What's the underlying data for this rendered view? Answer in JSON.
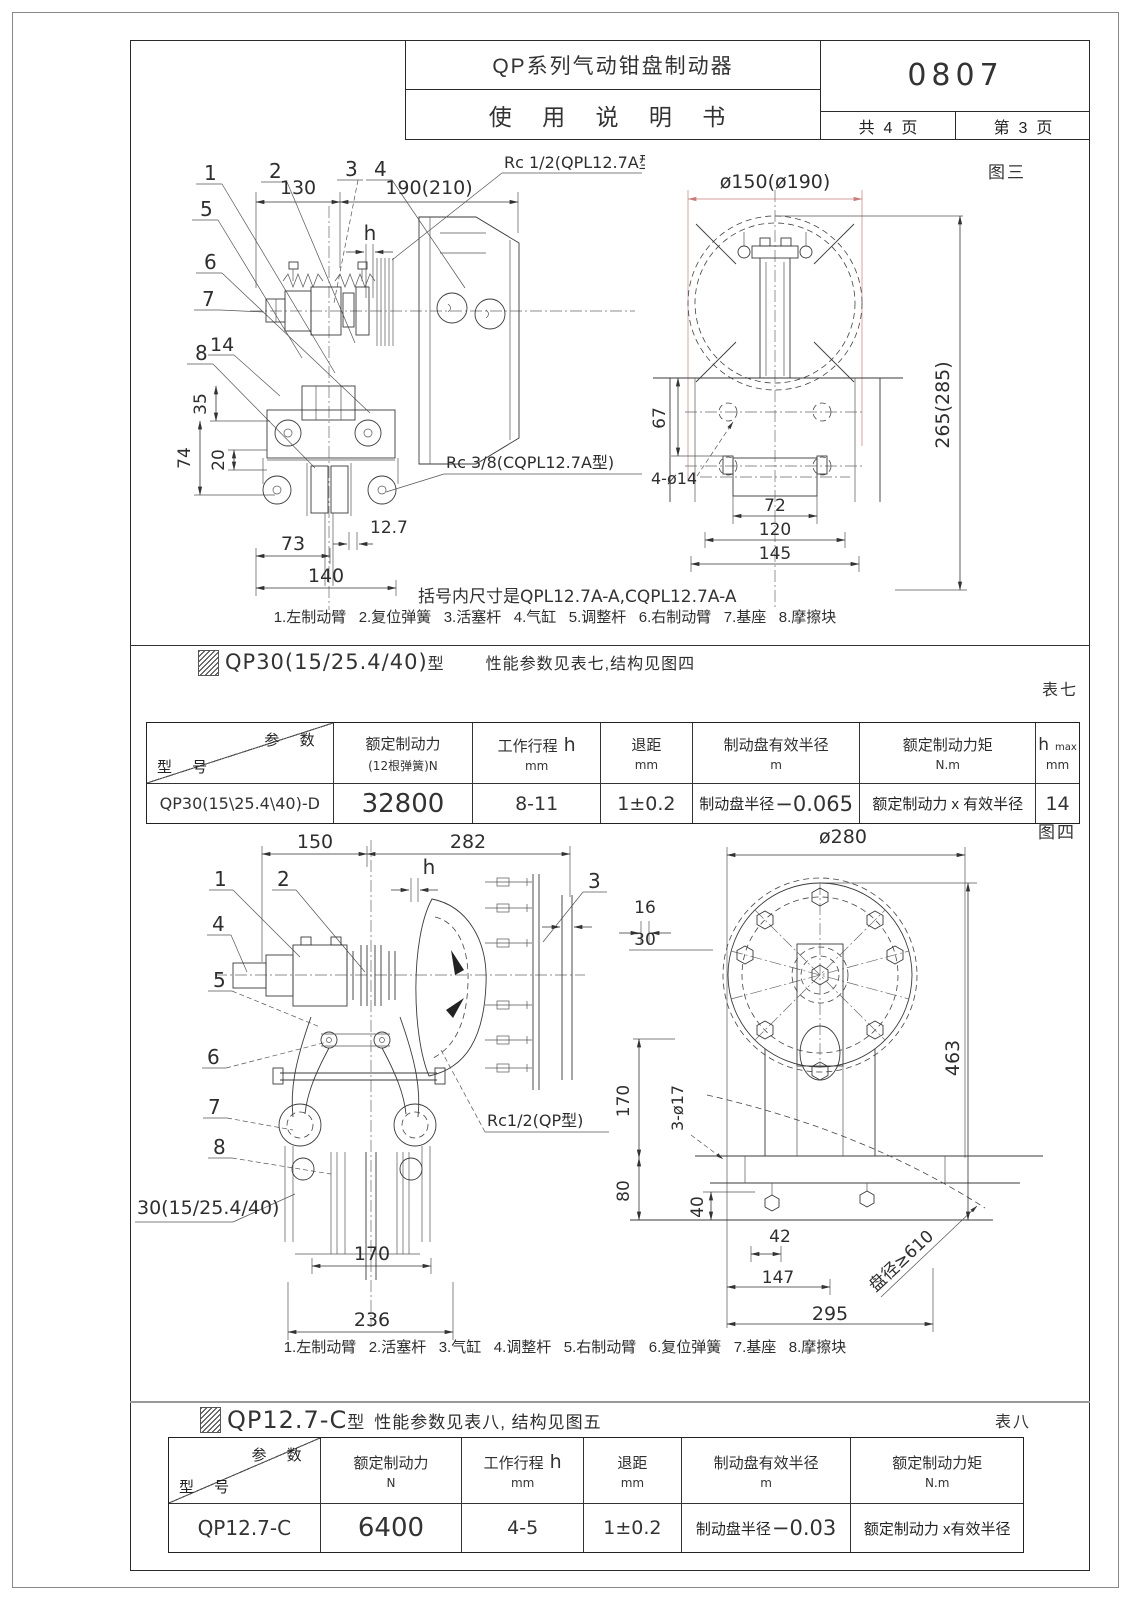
{
  "colors": {
    "dim_red": "#c87c7c",
    "line": "#333333"
  },
  "title_block": {
    "product": "QP系列气动钳盘制动器",
    "doc_type": "使 用 说 明 书",
    "doc_no": "0807",
    "pages_total": "共  4  页",
    "page_no": "第  3  页"
  },
  "fig3": {
    "caption": "图三",
    "note": "括号内尺寸是QPL12.7A-A,CQPL12.7A-A",
    "legend": "1.左制动臂   2.复位弹簧   3.活塞杆   4.气缸   5.调整杆   6.右制动臂   7.基座   8.摩擦块",
    "labels": {
      "n1": "1",
      "n2": "2",
      "n3": "3",
      "n4": "4",
      "n5": "5",
      "n6": "6",
      "n7": "7",
      "n8": "8",
      "n14": "14"
    },
    "dims": {
      "w130": "130",
      "w190": "190(210)",
      "h": "h",
      "rc12": "Rc 1/2(QPL12.7A型)",
      "rc38": "Rc 3/8(CQPL12.7A型)",
      "v35": "35",
      "v74": "74",
      "v20": "20",
      "t127": "12.7",
      "w73": "73",
      "w140": "140",
      "dia150": "ø150(ø190)",
      "v265": "265(285)",
      "v67": "67",
      "holes": "4-ø14",
      "w72": "72",
      "w120": "120",
      "w145": "145"
    }
  },
  "sec7": {
    "model": "QP30(15/25.4/40)",
    "suffix": "型",
    "desc": "性能参数见表七,结构见图四",
    "tag": "表七"
  },
  "table7": {
    "corner_top": "参 数",
    "corner_bottom": "型 号",
    "c1": {
      "t": "额定制动力",
      "s": "(12根弹簧)N"
    },
    "c2": {
      "t": "工作行程",
      "t2": "h",
      "s": "mm"
    },
    "c3": {
      "t": "退距",
      "s": "mm"
    },
    "c4": {
      "t": "制动盘有效半径",
      "s": "m"
    },
    "c5": {
      "t": "额定制动力矩",
      "s": "N.m"
    },
    "c6": {
      "t": "h",
      "tsub": "max",
      "s": "mm"
    },
    "row": {
      "model": "QP30(15\\25.4\\40)-D",
      "force": "32800",
      "stroke": "8-11",
      "retract": "1±0.2",
      "radius_label": "制动盘半径",
      "radius_value": "−0.065",
      "torque": "额定制动力 x 有效半径",
      "hmax": "14"
    }
  },
  "fig4": {
    "caption": "图四",
    "legend": "1.左制动臂   2.活塞杆   3.气缸   4.调整杆   5.右制动臂   6.复位弹簧   7.基座   8.摩擦块",
    "model_callout": "30(15/25.4/40)",
    "labels": {
      "n1": "1",
      "n2": "2",
      "n3": "3",
      "n4": "4",
      "n5": "5",
      "n6": "6",
      "n7": "7",
      "n8": "8"
    },
    "dims": {
      "w150": "150",
      "w282": "282",
      "h": "h",
      "rc": "Rc1/2(QP型)",
      "w170": "170",
      "w236": "236",
      "dia280": "ø280",
      "v463": "463",
      "t16": "16",
      "t30": "30",
      "v170": "170",
      "v80": "80",
      "v40": "40",
      "holes": "3-ø17",
      "w42": "42",
      "w147": "147",
      "w295": "295",
      "disc": "盘径≥610"
    }
  },
  "sec8": {
    "model": "QP12.7-C",
    "suffix": "型",
    "desc": "性能参数见表八, 结构见图五",
    "tag": "表八"
  },
  "table8": {
    "corner_top": "参 数",
    "corner_bottom": "型 号",
    "c1": {
      "t": "额定制动力",
      "s": "N"
    },
    "c2": {
      "t": "工作行程",
      "t2": "h",
      "s": "mm"
    },
    "c3": {
      "t": "退距",
      "s": "mm"
    },
    "c4": {
      "t": "制动盘有效半径",
      "s": "m"
    },
    "c5": {
      "t": "额定制动力矩",
      "s": "N.m"
    },
    "row": {
      "model": "QP12.7-C",
      "force": "6400",
      "stroke": "4-5",
      "retract": "1±0.2",
      "radius_label": "制动盘半径",
      "radius_value": "−0.03",
      "torque": "额定制动力 x有效半径"
    }
  }
}
